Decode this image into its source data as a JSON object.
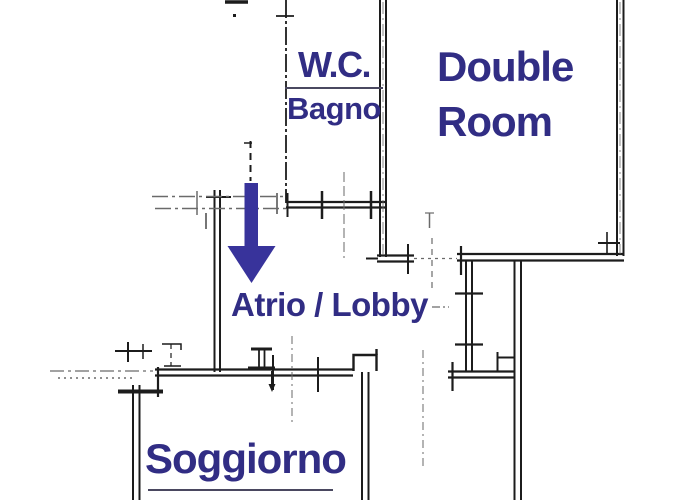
{
  "colors": {
    "label_text": "#312d84",
    "arrow": "#38339b",
    "wall": "#1c1c1c",
    "faint_line": "#6a6a6a",
    "divider": "#4a4860"
  },
  "rooms": {
    "wc": {
      "line1": "W.C.",
      "line2": "Bagno"
    },
    "double_room": {
      "line1": "Double",
      "line2": "Room"
    },
    "lobby": {
      "label": "Atrio / Lobby"
    },
    "living_room": {
      "label": "Soggiorno"
    }
  }
}
